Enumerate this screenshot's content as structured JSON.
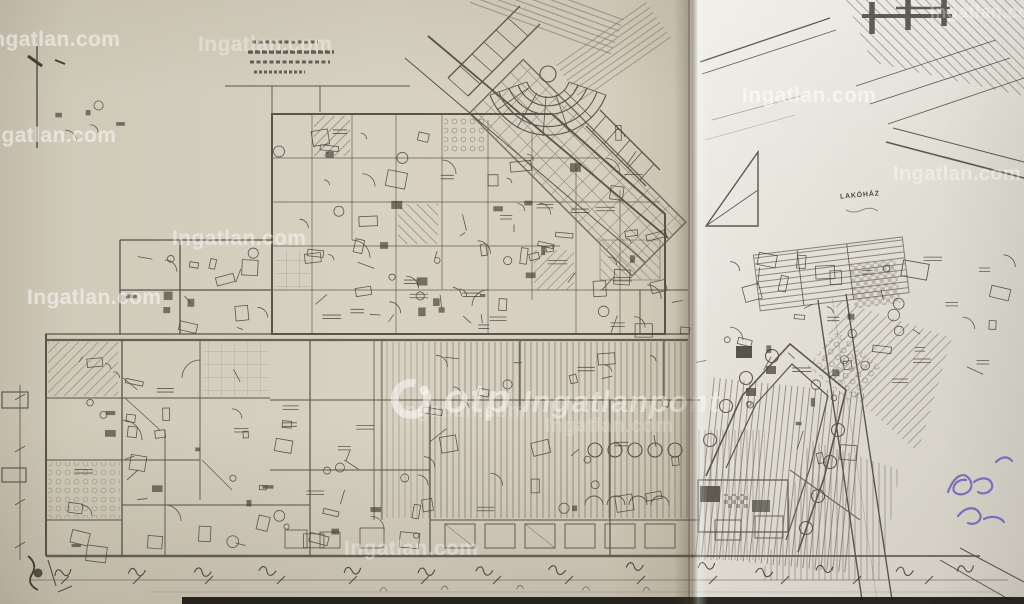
{
  "watermark": {
    "text": "Ingatlan.com"
  },
  "brand_overlay": {
    "otp": "otp",
    "name": "Ingatlanpont",
    "icon": "otp-ring-icon"
  },
  "plan": {
    "building_label": "LAKÓHÁZ"
  },
  "colors": {
    "paper_left": "#d3ccbc",
    "paper_right": "#e4e1da",
    "ink": "#3f3a32",
    "ink_dark": "#26221c",
    "watermark_white": "#ffffff",
    "pen_blue": "#5b50b8",
    "fold_shadow": "#564c3a",
    "bottom_band": "#15130f"
  }
}
